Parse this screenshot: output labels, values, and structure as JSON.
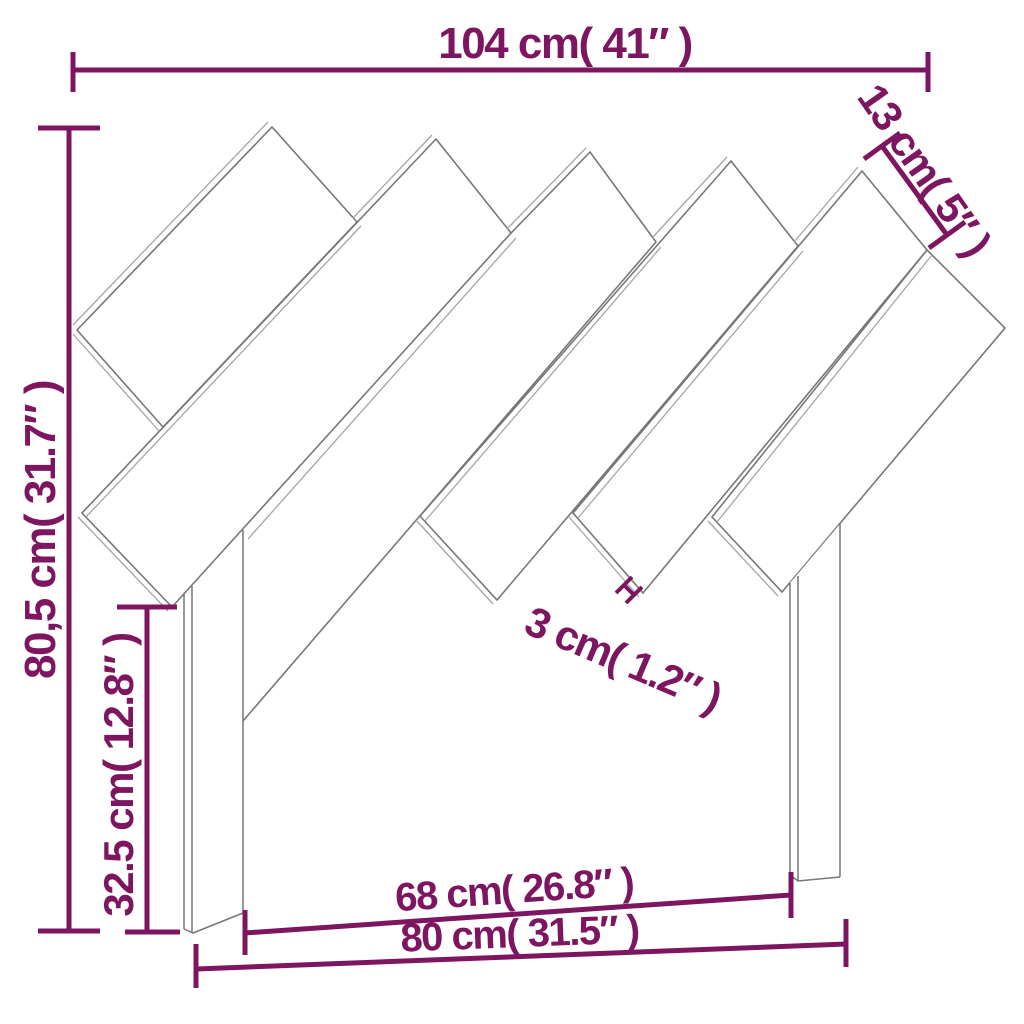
{
  "diagram": {
    "type": "furniture-dimension-drawing",
    "subject": "headboard with diagonal slats and two legs",
    "units": "cm and inches",
    "labels": {
      "total_width": "104 cm( 41″ )",
      "total_height": "80,5 cm( 31.7″ )",
      "leg_height": "32.5 cm( 12.8″ )",
      "slat_width": "13 cm( 5″ )",
      "slat_gap": "3 cm( 1.2″ )",
      "inner_width": "68 cm( 26.8″ )",
      "outer_width": "80 cm( 31.5″ )"
    },
    "colors": {
      "dimension": "#7D1560",
      "outline": "#777777",
      "outline_light": "#A5A5A5",
      "background": "#FFFFFF"
    }
  }
}
